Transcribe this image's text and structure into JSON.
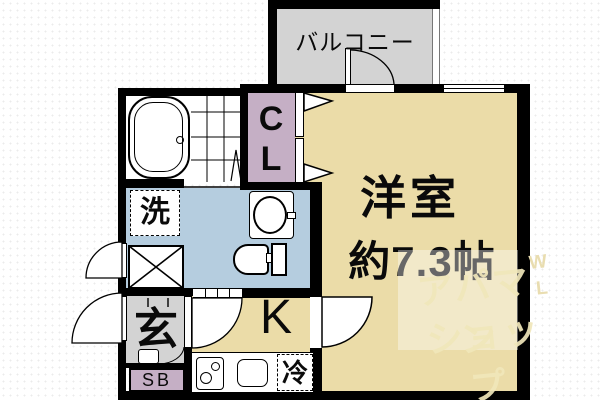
{
  "rooms": {
    "balcony": {
      "label": "バルコニー"
    },
    "western_room": {
      "label": "洋室",
      "size": "約7.3帖"
    },
    "closet": {
      "letters": [
        "C",
        "L"
      ]
    },
    "kitchen": {
      "label": "K"
    },
    "entrance": {
      "label": "玄"
    },
    "washer": {
      "label": "洗"
    },
    "refrigerator": {
      "label": "冷"
    },
    "shoe_box": {
      "label": "SB"
    }
  },
  "watermark": {
    "line1": "アパマン",
    "line2": "ショップ",
    "letter_w": "W",
    "letter_l": "L"
  },
  "colors": {
    "room_tan": "#EBDCA8",
    "balcony_gray": "#D3D3D3",
    "entrance_gray": "#D3D3D3",
    "closet_mauve": "#C5AFC5",
    "washroom_blue": "#B5CDDF",
    "wall_black": "#000000",
    "watermark_cream": "#F0E6BC"
  }
}
